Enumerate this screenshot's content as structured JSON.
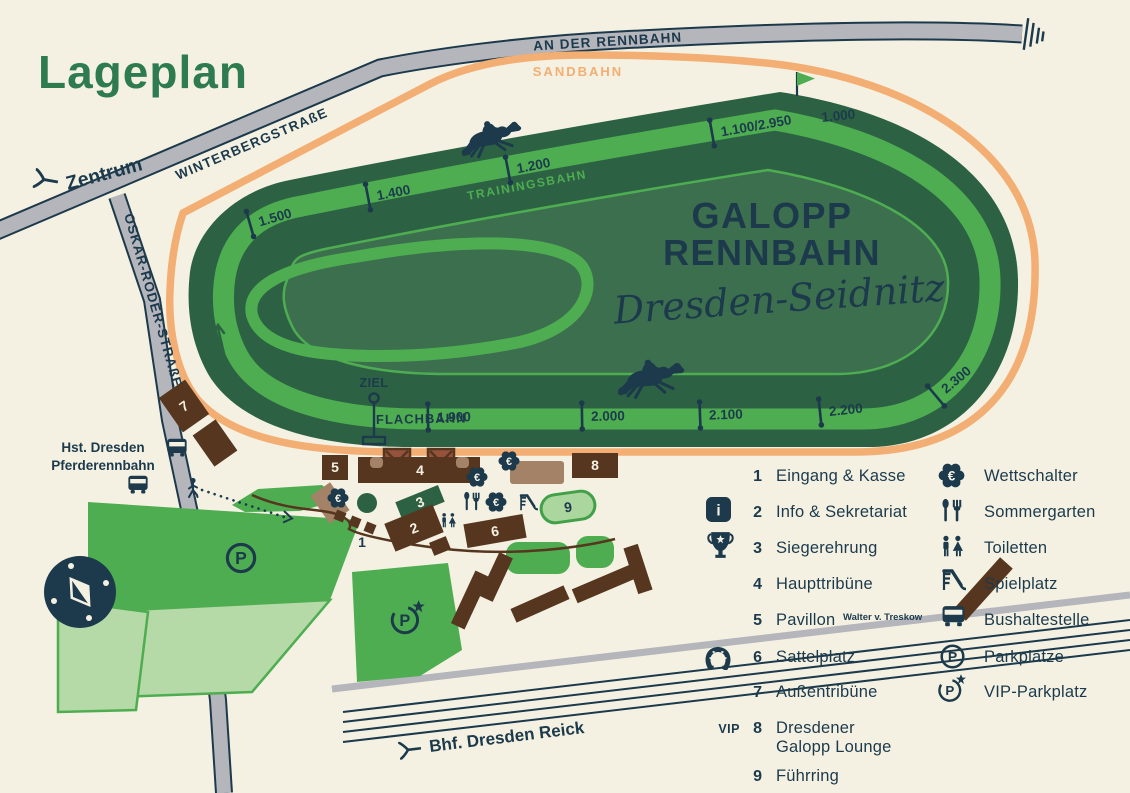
{
  "title": "Lageplan",
  "track": {
    "name_line1": "GALOPP",
    "name_line2": "RENNBAHN",
    "name_script": "Dresden-Seidnitz",
    "sandbahn": "SANDBAHN",
    "trainingsbahn": "TRAININGSBAHN",
    "flachbahn": "FLACHBAHN",
    "ziel": "ZIEL",
    "distance_markers": [
      "1.500",
      "1.400",
      "1.200",
      "1.100/2.950",
      "1.000",
      "1.900",
      "2.000",
      "2.100",
      "2.200",
      "2.300"
    ]
  },
  "roads": {
    "an_der_rennbahn": "AN DER RENNBAHN",
    "winterbergstrasse": "WINTERBERGSTRAßE",
    "oskar_roeder_strasse": "OSKAR-RÖDER-STRAßE",
    "zentrum": "Zentrum",
    "bhf_dresden_reick": "Bhf. Dresden Reick",
    "hst_line1": "Hst. Dresden",
    "hst_line2": "Pferderennbahn"
  },
  "legend": {
    "column1": [
      {
        "num": "1",
        "label": "Eingang & Kasse"
      },
      {
        "num": "2",
        "label": "Info & Sekretariat"
      },
      {
        "num": "3",
        "label": "Siegerehrung"
      },
      {
        "num": "4",
        "label": "Haupttribüne"
      },
      {
        "num": "5",
        "label": "Pavillon",
        "suffix": "Walter v. Treskow"
      },
      {
        "num": "6",
        "label": "Sattelplatz"
      },
      {
        "num": "7",
        "label": "Außentribüne"
      },
      {
        "num": "8",
        "label": "Dresdener",
        "label_line2": "Galopp Lounge"
      },
      {
        "num": "9",
        "label": "Führring"
      }
    ],
    "column2": [
      {
        "label": "Wettschalter"
      },
      {
        "label": "Sommergarten"
      },
      {
        "label": "Toiletten"
      },
      {
        "label": "Spielplatz"
      },
      {
        "label": "Bushaltestelle"
      },
      {
        "label": "Parkplätze"
      },
      {
        "label": "VIP-Parkplatz"
      }
    ],
    "vip_badge": "VIP"
  },
  "icons": {
    "euro": "€",
    "parking_letter": "P",
    "info_letter": "i"
  },
  "colors": {
    "background": "#f4f1e2",
    "navy": "#1c3a4c",
    "title_green": "#2e7b4f",
    "track_dark_green": "#2c6243",
    "track_bright_green": "#4ead51",
    "infield_green": "#3b6f4e",
    "sand_orange": "#f3ae74",
    "road_gray": "#b5b5bc",
    "building_brown": "#56361f",
    "building_tan": "#a38267",
    "tower_redbrown": "#96523a",
    "pale_green": "#b6d9a8",
    "fuehrring_fill": "#abd69e",
    "fuehrring_stroke": "#41a048"
  }
}
